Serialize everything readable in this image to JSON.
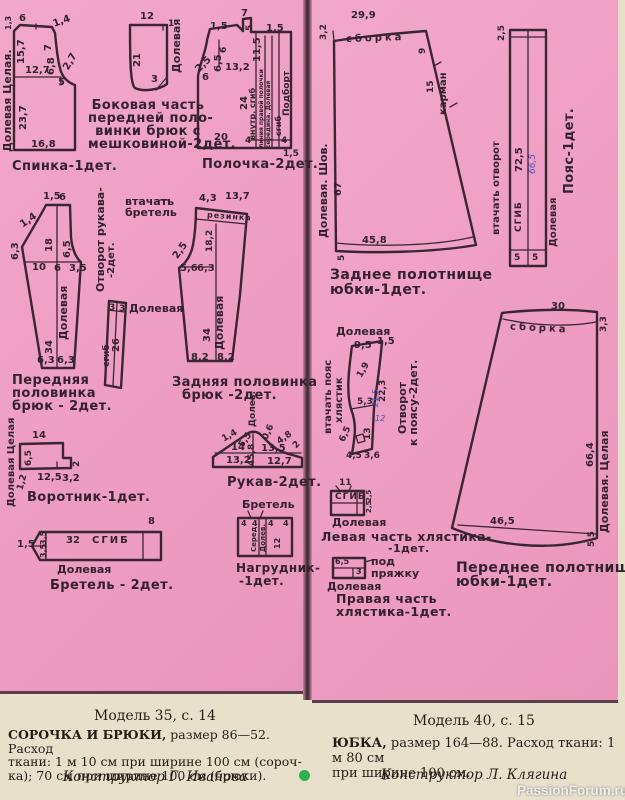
{
  "colors": {
    "paper_pink": "#ef9fc3",
    "ink": "#3a2630",
    "paper_cream": "#e9e0cc",
    "accent_dot": "#2db14f",
    "handwriting_blue": "#3f51c9"
  },
  "watermark": "PassionForum.ru",
  "footer": {
    "left": {
      "model": "Модель 35, с. 14",
      "lead": "СОРОЧКА И БРЮКИ,",
      "l1": "размер  86—52.  Расход",
      "l2": "ткани: 1 м 10 см при ширине 100 см (сороч-",
      "l3": "ка); 70 см при ширине 100 см (брюки).",
      "designer": "Конструктор Г. Иванова"
    },
    "right": {
      "model": "Модель 40, с. 15",
      "lead": "ЮБКА,",
      "l1": "размер 164—88. Расход ткани: 1 м 80 см",
      "l2": "при ширине 100 см.",
      "designer": "Конструктор Л. Клягина"
    }
  },
  "pieces": {
    "spinka": {
      "caption": "Спинка-1дет.",
      "grain": "Долевая Целая.",
      "dims": [
        "1,3",
        "6",
        "1,4",
        "15,7",
        "7",
        "6,8",
        "2,7",
        "12,7",
        "5",
        "23,7",
        "16,8"
      ]
    },
    "bokovaya": {
      "caption": [
        "Боковая часть",
        "передней поло-",
        "винки брюк с",
        "мешковиной-2дет."
      ],
      "grain": "Долевая",
      "dims": [
        "12",
        "1",
        "21",
        "3"
      ]
    },
    "polochka": {
      "caption": "Полочка-2дет.",
      "dims": [
        "7",
        "1,5",
        "5",
        "1,5",
        "6",
        "6,5",
        "11,5",
        "2,5",
        "13,2",
        "6",
        "24",
        "20",
        "4",
        "4",
        "1,5"
      ],
      "marks": [
        "внутр. сгиб",
        "линия правой полочки",
        "середина. Долевая",
        "сгиб",
        "Подборт"
      ]
    },
    "perednyaya": {
      "caption": [
        "Передняя",
        "половинка",
        "брюк - 2дет."
      ],
      "grain": "Долевая",
      "dims": [
        "1,5",
        "6",
        "1,4",
        "6,3",
        "18",
        "6,5",
        "10",
        "6",
        "3,5",
        "34",
        "6,3",
        "6,3"
      ]
    },
    "otvorot_rukava": {
      "label": [
        "Отворот рукава-",
        "-2дет."
      ]
    },
    "vtachat_bretel": {
      "label": [
        "втачать",
        "бретель"
      ]
    },
    "strip": {
      "grain": "Долевая",
      "marks": [
        "сгиб"
      ],
      "dims": [
        "3",
        "3",
        "26"
      ]
    },
    "zadnyaya": {
      "caption": [
        "Задняя половинка",
        "брюк -2дет."
      ],
      "grain": "Долевая",
      "marks": [
        "резинка"
      ],
      "dims": [
        "4,3",
        "13,7",
        "18,2",
        "2,5",
        "5,6",
        "6,3",
        "34",
        "8,2",
        "8,2"
      ]
    },
    "vorotnik": {
      "caption": "Воротник-1дет.",
      "grain": "Долевая Целая",
      "dims": [
        "14",
        "6,5",
        "2",
        "1,2",
        "12,5",
        "3,2"
      ]
    },
    "rukav": {
      "caption": "Рукав-2дет.",
      "grain": "Долев.",
      "dims": [
        "1,4",
        "5,5",
        "0,6",
        "4,8",
        "2",
        "14",
        "13,5",
        "45,8",
        "13,2",
        "12,7"
      ]
    },
    "bretel": {
      "caption": "Бретель - 2дет.",
      "grain": "Долевая",
      "marks": [
        "СГИБ"
      ],
      "dims": [
        "8",
        "1,5",
        "3,5",
        "3,5",
        "32"
      ]
    },
    "nagrudnik": {
      "caption": [
        "Нагрудник-",
        "-1дет."
      ],
      "marks": [
        "Бретель",
        "Серед.",
        "Долев."
      ],
      "dims": [
        "4",
        "4",
        "4",
        "4",
        "12"
      ]
    },
    "zadnee": {
      "caption": [
        "Заднее полотнище",
        "юбки-1дет."
      ],
      "grain": "Долевая. Шов.",
      "marks": [
        "сборка",
        "карман"
      ],
      "dims": [
        "29,9",
        "3,2",
        "9",
        "15",
        "67",
        "45,8",
        "5"
      ]
    },
    "poyas": {
      "caption": "Пояс-1дет.",
      "grain": "Долевая",
      "marks": [
        "втачать отворот",
        "СГИБ"
      ],
      "dims": [
        "2,5",
        "72,5",
        "5",
        "5"
      ],
      "handwritten": "66,5"
    },
    "otvorot_poyas": {
      "caption": [
        "Отворот",
        "к поясу-2дет."
      ],
      "grain": "Долевая",
      "marks": [
        "втачать пояс",
        "хлястик"
      ],
      "dims": [
        "9,5",
        "1,5",
        "1,9",
        "22,3",
        "5,3",
        "13",
        "6,5",
        "4,5",
        "3,6"
      ],
      "handwritten": [
        "21,5",
        "12"
      ]
    },
    "levaya": {
      "caption": [
        "Левая часть хлястика-",
        "-1дет."
      ],
      "grain": "Долевая",
      "marks": [
        "СГИБ"
      ],
      "dims": [
        "11",
        "2,5",
        "2,5"
      ]
    },
    "pravaya": {
      "caption": [
        "Правая часть",
        "хлястика-1дет."
      ],
      "grain": "Долевая",
      "marks": [
        "под",
        "пряжку"
      ],
      "dims": [
        "6,5",
        "3"
      ]
    },
    "perednee": {
      "caption": [
        "Переднее полотнище",
        "юбки-1дет."
      ],
      "grain": "Долевая. Целая",
      "marks": [
        "сборка"
      ],
      "dims": [
        "30",
        "3,3",
        "66,4",
        "46,5",
        "5,5"
      ]
    }
  }
}
